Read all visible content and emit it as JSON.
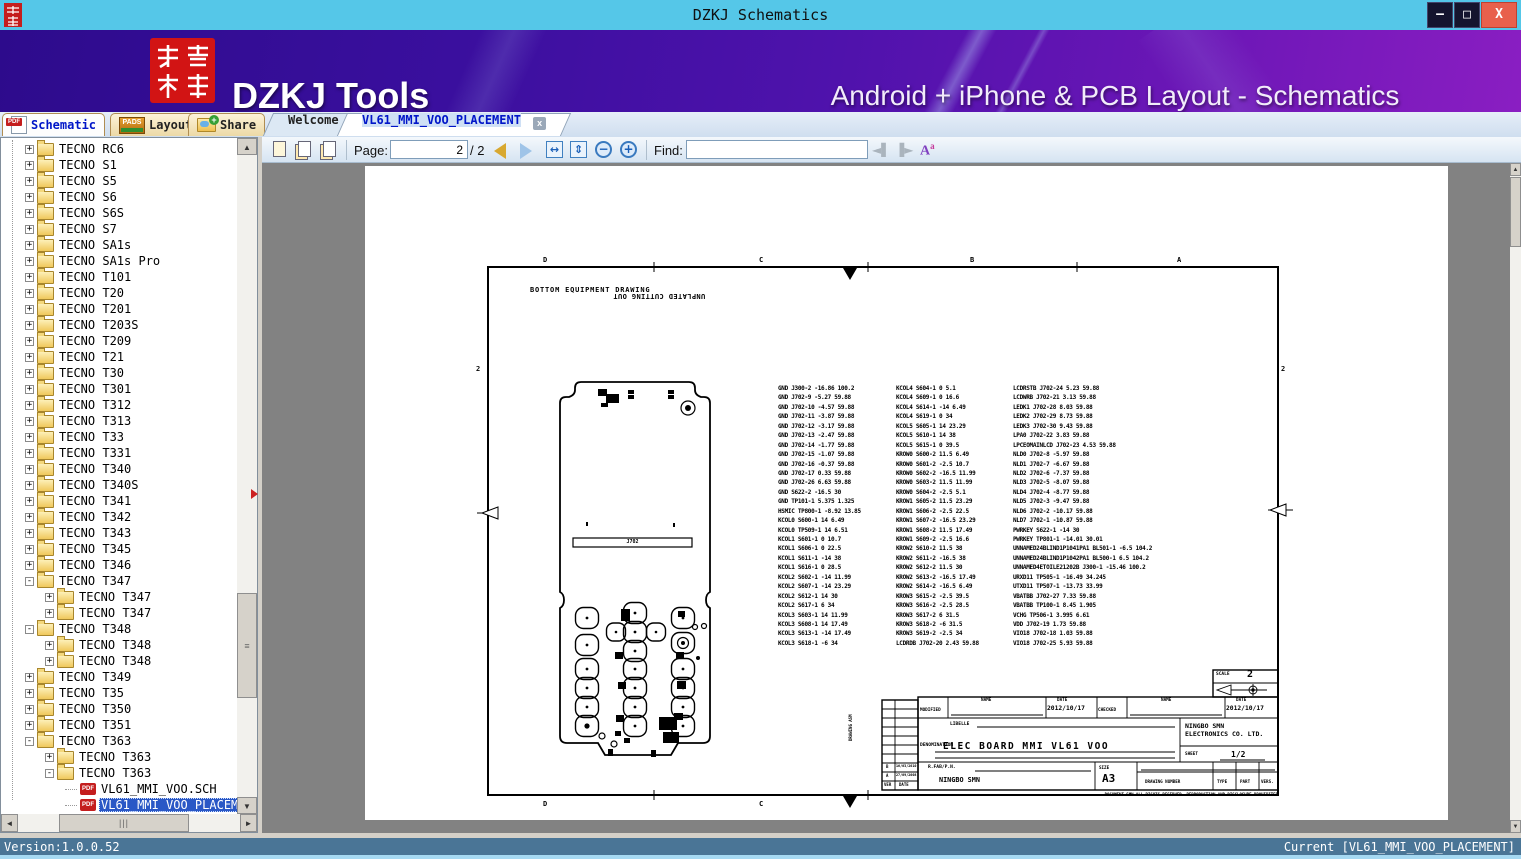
{
  "window": {
    "title": "DZKJ Schematics",
    "logo_text": "东震科技",
    "controls": {
      "minimize": "–",
      "maximize": "□",
      "close": "X"
    }
  },
  "banner": {
    "logo_text": "东震科技",
    "brand": "DZKJ Tools",
    "tagline": "Android + iPhone & PCB Layout - Schematics"
  },
  "tabs": {
    "main": [
      {
        "label": "Schematic"
      },
      {
        "label": "Layout"
      },
      {
        "label": "Share"
      }
    ],
    "docs": [
      {
        "label": "Welcome"
      },
      {
        "label": "VL61_MMI_VOO_PLACEMENT"
      }
    ],
    "close_glyph": "x"
  },
  "toolbar": {
    "page_label": "Page:",
    "page_value": "2",
    "page_total": "/ 2",
    "find_label": "Find:",
    "find_value": "",
    "icons": [
      "page-view",
      "previous-view",
      "next-view",
      "prev-page",
      "next-page",
      "fit-width",
      "fit-page",
      "zoom-out",
      "zoom-in",
      "find-previous",
      "find-next",
      "font-size"
    ]
  },
  "tree": {
    "items": [
      {
        "label": "TECNO RC6",
        "level": 1,
        "toggle": "plus",
        "icon": "folder"
      },
      {
        "label": "TECNO S1",
        "level": 1,
        "toggle": "plus",
        "icon": "folder"
      },
      {
        "label": "TECNO S5",
        "level": 1,
        "toggle": "plus",
        "icon": "folder"
      },
      {
        "label": "TECNO S6",
        "level": 1,
        "toggle": "plus",
        "icon": "folder"
      },
      {
        "label": "TECNO S6S",
        "level": 1,
        "toggle": "plus",
        "icon": "folder"
      },
      {
        "label": "TECNO S7",
        "level": 1,
        "toggle": "plus",
        "icon": "folder"
      },
      {
        "label": "TECNO SA1s",
        "level": 1,
        "toggle": "plus",
        "icon": "folder"
      },
      {
        "label": "TECNO SA1s Pro",
        "level": 1,
        "toggle": "plus",
        "icon": "folder"
      },
      {
        "label": "TECNO T101",
        "level": 1,
        "toggle": "plus",
        "icon": "folder"
      },
      {
        "label": "TECNO T20",
        "level": 1,
        "toggle": "plus",
        "icon": "folder"
      },
      {
        "label": "TECNO T201",
        "level": 1,
        "toggle": "plus",
        "icon": "folder"
      },
      {
        "label": "TECNO T203S",
        "level": 1,
        "toggle": "plus",
        "icon": "folder"
      },
      {
        "label": "TECNO T209",
        "level": 1,
        "toggle": "plus",
        "icon": "folder"
      },
      {
        "label": "TECNO T21",
        "level": 1,
        "toggle": "plus",
        "icon": "folder"
      },
      {
        "label": "TECNO T30",
        "level": 1,
        "toggle": "plus",
        "icon": "folder"
      },
      {
        "label": "TECNO T301",
        "level": 1,
        "toggle": "plus",
        "icon": "folder"
      },
      {
        "label": "TECNO T312",
        "level": 1,
        "toggle": "plus",
        "icon": "folder"
      },
      {
        "label": "TECNO T313",
        "level": 1,
        "toggle": "plus",
        "icon": "folder"
      },
      {
        "label": "TECNO T33",
        "level": 1,
        "toggle": "plus",
        "icon": "folder"
      },
      {
        "label": "TECNO T331",
        "level": 1,
        "toggle": "plus",
        "icon": "folder"
      },
      {
        "label": "TECNO T340",
        "level": 1,
        "toggle": "plus",
        "icon": "folder"
      },
      {
        "label": "TECNO T340S",
        "level": 1,
        "toggle": "plus",
        "icon": "folder"
      },
      {
        "label": "TECNO T341",
        "level": 1,
        "toggle": "plus",
        "icon": "folder"
      },
      {
        "label": "TECNO T342",
        "level": 1,
        "toggle": "plus",
        "icon": "folder"
      },
      {
        "label": "TECNO T343",
        "level": 1,
        "toggle": "plus",
        "icon": "folder"
      },
      {
        "label": "TECNO T345",
        "level": 1,
        "toggle": "plus",
        "icon": "folder"
      },
      {
        "label": "TECNO T346",
        "level": 1,
        "toggle": "plus",
        "icon": "folder"
      },
      {
        "label": "TECNO T347",
        "level": 1,
        "toggle": "minus",
        "icon": "folder"
      },
      {
        "label": "TECNO T347",
        "level": 2,
        "toggle": "plus",
        "icon": "folder"
      },
      {
        "label": "TECNO T347",
        "level": 2,
        "toggle": "plus",
        "icon": "folder"
      },
      {
        "label": "TECNO T348",
        "level": 1,
        "toggle": "minus",
        "icon": "folder"
      },
      {
        "label": "TECNO T348",
        "level": 2,
        "toggle": "plus",
        "icon": "folder"
      },
      {
        "label": "TECNO T348",
        "level": 2,
        "toggle": "plus",
        "icon": "folder"
      },
      {
        "label": "TECNO T349",
        "level": 1,
        "toggle": "plus",
        "icon": "folder"
      },
      {
        "label": "TECNO T35",
        "level": 1,
        "toggle": "plus",
        "icon": "folder"
      },
      {
        "label": "TECNO T350",
        "level": 1,
        "toggle": "plus",
        "icon": "folder"
      },
      {
        "label": "TECNO T351",
        "level": 1,
        "toggle": "plus",
        "icon": "folder"
      },
      {
        "label": "TECNO T363",
        "level": 1,
        "toggle": "minus",
        "icon": "folder"
      },
      {
        "label": "TECNO T363",
        "level": 2,
        "toggle": "plus",
        "icon": "folder"
      },
      {
        "label": "TECNO T363",
        "level": 2,
        "toggle": "minus",
        "icon": "folder"
      },
      {
        "label": "VL61_MMI_VOO.SCH",
        "level": 3,
        "toggle": "none",
        "icon": "pdf"
      },
      {
        "label": "VL61_MMI_VOO_PLACEMENT",
        "level": 3,
        "toggle": "none",
        "icon": "pdf",
        "selected": true
      }
    ]
  },
  "drawing": {
    "heading": "BOTTOM EQUIPMENT DRAWING",
    "heading_flipped": "UNPLATED CUTTING OUT",
    "connector_label": "J702",
    "frame": {
      "top_labels": [
        "D",
        "C",
        "B",
        "A"
      ],
      "bottom_labels": [
        "D",
        "C"
      ],
      "left_label": "2",
      "right_label": "2"
    },
    "placement_columns": [
      [
        "GND J300-2 -16.86 100.2",
        "GND J702-9 -5.27 59.88",
        "GND J702-10 -4.57 59.88",
        "GND J702-11 -3.87 59.88",
        "GND J702-12 -3.17 59.88",
        "GND J702-13 -2.47 59.88",
        "GND J702-14 -1.77 59.88",
        "GND J702-15 -1.07 59.88",
        "GND J702-16 -0.37 59.88",
        "GND J702-17 0.33 59.88",
        "GND J702-26 6.63 59.88",
        "GND S622-2 -16.5 30",
        "GND TP101-1 5.375 1.325",
        "HSMIC TP800-1 -8.92 13.85",
        "KCOL0 S600-1 14 6.49",
        "KCOL0 TP509-1 14 6.51",
        "KCOL1 S601-1 0 10.7",
        "KCOL1 S606-1 0 22.5",
        "KCOL1 S611-1 -14 38",
        "KCOL1 S616-1 0 28.5",
        "KCOL2 S602-1 -14 11.99",
        "KCOL2 S607-1 -14 23.29",
        "KCOL2 S612-1 14 30",
        "KCOL2 S617-1 6 34",
        "KCOL3 S603-1 14 11.99",
        "KCOL3 S608-1 14 17.49",
        "KCOL3 S613-1 -14 17.49",
        "KCOL3 S618-1 -6 34"
      ],
      [
        "KCOL4 S604-1 0 5.1",
        "KCOL4 S609-1 0 16.6",
        "KCOL4 S614-1 -14 6.49",
        "KCOL4 S619-1 0 34",
        "KCOL5 S605-1 14 23.29",
        "KCOL5 S610-1 14 38",
        "KCOL5 S615-1 0 39.5",
        "KROW0 S600-2 11.5 6.49",
        "KROW0 S601-2 -2.5 10.7",
        "KROW0 S602-2 -16.5 11.99",
        "KROW0 S603-2 11.5 11.99",
        "KROW0 S604-2 -2.5 5.1",
        "KROW1 S605-2 11.5 23.29",
        "KROW1 S606-2 -2.5 22.5",
        "KROW1 S607-2 -16.5 23.29",
        "KROW1 S608-2 11.5 17.49",
        "KROW1 S609-2 -2.5 16.6",
        "KROW2 S610-2 11.5 38",
        "KROW2 S611-2 -16.5 38",
        "KROW2 S612-2 11.5 30",
        "KROW2 S613-2 -16.5 17.49",
        "KROW2 S614-2 -16.5 6.49",
        "KROW3 S615-2 -2.5 39.5",
        "KROW3 S616-2 -2.5 28.5",
        "KROW3 S617-2 6 31.5",
        "KROW3 S618-2 -6 31.5",
        "KROW3 S619-2 -2.5 34",
        "LCDRDB J702-20 2.43 59.88"
      ],
      [
        "LCDRSTB J702-24 5.23 59.88",
        "LCDWRB J702-21 3.13 59.88",
        "LEDK1 J702-28 8.03 59.88",
        "LEDK2 J702-29 8.73 59.88",
        "LEDK3 J702-30 9.43 59.88",
        "LPA0 J702-22 3.83 59.88",
        "LPCEOMAINLCD J702-23 4.53 59.88",
        "NLD0 J702-8 -5.97 59.88",
        "NLD1 J702-7 -6.67 59.88",
        "NLD2 J702-6 -7.37 59.88",
        "NLD3 J702-5 -8.07 59.88",
        "NLD4 J702-4 -8.77 59.88",
        "NLD5 J702-3 -9.47 59.88",
        "NLD6 J702-2 -10.17 59.88",
        "NLD7 J702-1 -10.87 59.88",
        "PWRKEY S622-1 -14 30",
        "PWRKEY TP801-1 -14.01 30.01",
        "UNNAMED24BLIND1P1041PA1 BL501-1 -6.5 104.2",
        "UNNAMED24BLIND1P1042PA1 BL500-1 6.5 104.2",
        "UNNAMED4ETOILE21202B J300-1 -15.46 100.2",
        "URXD11 TP505-1 -16.49 34.245",
        "UTXD11 TP507-1 -13.73 33.99",
        "VBATBB J702-27 7.33 59.88",
        "VBATBB TP100-1 8.45 1.905",
        "VCHG TP506-1 3.995 6.61",
        "VDD J702-19 1.73 59.88",
        "VIO18 J702-18 1.03 59.88",
        "VIO18 J702-25 5.93 59.88"
      ]
    ],
    "titleblock": {
      "scale_label": "SCALE",
      "scale_value": "2",
      "modified_label": "MODIFIED",
      "checked_label": "CHECKED",
      "name_label": "NAME",
      "name2_label": "NAME",
      "date_label": "DATE",
      "date2_label": "DATE",
      "date_value": "2012/10/17",
      "date2_value": "2012/10/17",
      "libelle_label": "LIBELLE",
      "denomination_label": "DENOMINATION",
      "denomination_value": "ELEC BOARD MMI VL61 VOO",
      "company_line1": "NINGBO SMN",
      "company_line2": "ELECTRONICS CO. LTD.",
      "sheet_label": "SHEET",
      "sheet_value": "1/2",
      "rfab_label": "R.FAB/P.N.",
      "rfab_value": "NINGBO SMN",
      "size_label": "SIZE",
      "size_value": "A3",
      "drawing_number_label": "DRAWING NUMBER",
      "type_label": "TYPE",
      "part_label": "PART",
      "vers_label": "VERS.",
      "rev_b": "B",
      "rev_b_date": "16/03/2010",
      "rev_a": "A",
      "rev_a_date": "27/09/2008",
      "ver_label": "VER",
      "date_col_label": "DATE",
      "drawing_asm": "DRAWING ASM",
      "footer": "DOCUMENT SMN ALL RIGHTS RESERVED. REPRODUCTION AND DISCLOSURE PROHIBITED"
    }
  },
  "statusbar": {
    "version": "Version:1.0.0.52",
    "current": "Current [VL61_MMI_VOO_PLACEMENT]"
  }
}
